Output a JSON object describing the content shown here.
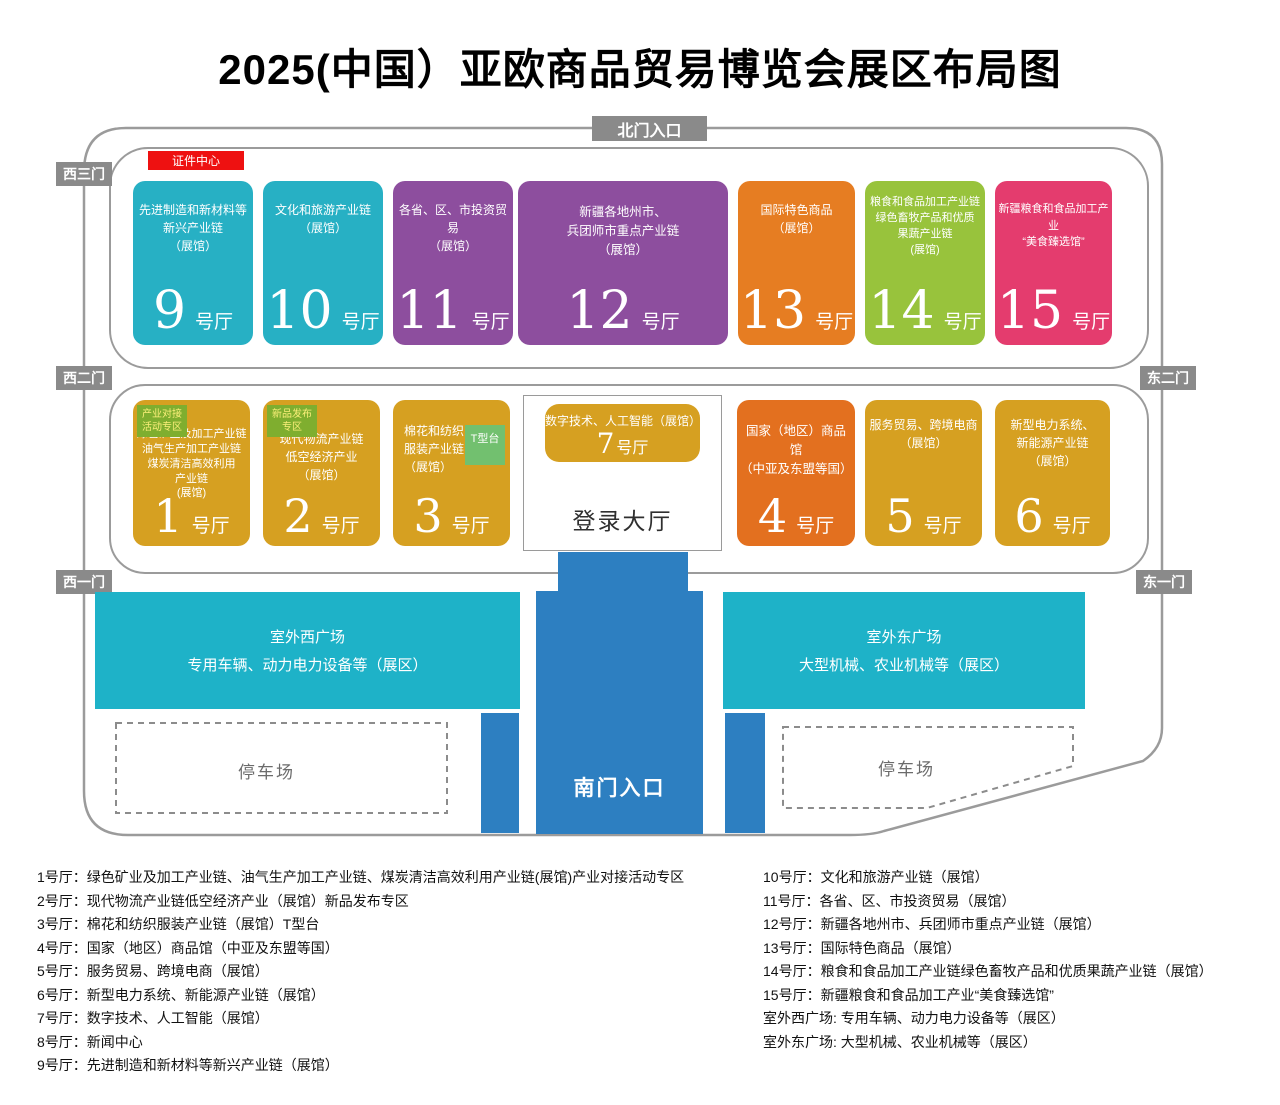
{
  "title": "2025(中国）亚欧商品贸易博览会展区布局图",
  "gates": {
    "north": "北门入口",
    "south": "南门入口",
    "west3": "西三门",
    "west2": "西二门",
    "west1": "西一门",
    "east2": "东二门",
    "east1": "东一门"
  },
  "credential_center": "证件中心",
  "login_hall": "登录大厅",
  "halls": {
    "h1": {
      "num": "1",
      "unit": "号厅",
      "desc": "绿色矿业及加工产业链\n油气生产加工产业链\n煤炭清洁高效利用\n产业链\n(展馆)",
      "badge": "产业对接\n活动专区",
      "color": "#d6a021"
    },
    "h2": {
      "num": "2",
      "unit": "号厅",
      "desc": "现代物流产业链\n低空经济产业\n（展馆）",
      "badge": "新品发布\n专区",
      "color": "#d6a021"
    },
    "h3": {
      "num": "3",
      "unit": "号厅",
      "desc": "棉花和纺织\n服装产业链\n（展馆）",
      "t_stage": "T型台",
      "color": "#d6a021"
    },
    "h4": {
      "num": "4",
      "unit": "号厅",
      "desc": "国家（地区）商品馆\n（中亚及东盟等国）",
      "color": "#e3701f"
    },
    "h5": {
      "num": "5",
      "unit": "号厅",
      "desc": "服务贸易、跨境电商\n（展馆）",
      "color": "#d6a021"
    },
    "h6": {
      "num": "6",
      "unit": "号厅",
      "desc": "新型电力系统、\n新能源产业链\n（展馆）",
      "color": "#d6a021"
    },
    "h7": {
      "num": "7",
      "unit": "号厅",
      "desc": "数字技术、人工智能（展馆）",
      "color": "#d6a021"
    },
    "h9": {
      "num": "9",
      "unit": "号厅",
      "desc": "先进制造和新材料等\n新兴产业链\n（展馆）",
      "color": "#27b0c4"
    },
    "h10": {
      "num": "10",
      "unit": "号厅",
      "desc": "文化和旅游产业链\n（展馆）",
      "color": "#27b0c4"
    },
    "h11": {
      "num": "11",
      "unit": "号厅",
      "desc": "各省、区、市投资贸易\n（展馆）",
      "color": "#8d4e9e"
    },
    "h12": {
      "num": "12",
      "unit": "号厅",
      "desc": "新疆各地州市、\n兵团师市重点产业链\n（展馆）",
      "color": "#8d4e9e"
    },
    "h13": {
      "num": "13",
      "unit": "号厅",
      "desc": "国际特色商品\n（展馆）",
      "color": "#e67d22"
    },
    "h14": {
      "num": "14",
      "unit": "号厅",
      "desc": "粮食和食品加工产业链\n绿色畜牧产品和优质\n果蔬产业链\n(展馆)",
      "color": "#98c33c"
    },
    "h15": {
      "num": "15",
      "unit": "号厅",
      "desc": "新疆粮食和食品加工产业\n“美食臻选馆”",
      "color": "#e43c6e"
    }
  },
  "plazas": {
    "west": {
      "name": "室外西广场",
      "desc": "专用车辆、动力电力设备等（展区）"
    },
    "east": {
      "name": "室外东广场",
      "desc": "大型机械、农业机械等（展区）"
    },
    "parking": "停车场"
  },
  "legend": {
    "left": [
      "1号厅：绿色矿业及加工产业链、油气生产加工产业链、煤炭清洁高效利用产业链(展馆)产业对接活动专区",
      "2号厅：现代物流产业链低空经济产业（展馆）新品发布专区",
      "3号厅：棉花和纺织服装产业链（展馆）T型台",
      "4号厅：国家（地区）商品馆（中亚及东盟等国）",
      "5号厅：服务贸易、跨境电商（展馆）",
      "6号厅：新型电力系统、新能源产业链（展馆）",
      "7号厅：数字技术、人工智能（展馆）",
      "8号厅：新闻中心",
      "9号厅：先进制造和新材料等新兴产业链（展馆）"
    ],
    "right": [
      "10号厅：文化和旅游产业链（展馆）",
      "11号厅：各省、区、市投资贸易（展馆）",
      "12号厅：新疆各地州市、兵团师市重点产业链（展馆）",
      "13号厅：国际特色商品（展馆）",
      "14号厅：粮食和食品加工产业链绿色畜牧产品和优质果蔬产业链（展馆）",
      "15号厅：新疆粮食和食品加工产业“美食臻选馆”",
      "室外西广场: 专用车辆、动力电力设备等（展区）",
      "室外东广场: 大型机械、农业机械等（展区）"
    ]
  },
  "colors": {
    "teal_hall": "#27b0c4",
    "purple_hall": "#8d4e9e",
    "orange_hall": "#e67d22",
    "deep_orange_hall": "#e3701f",
    "green_hall": "#98c33c",
    "pink_hall": "#e43c6e",
    "gold_hall": "#d6a021",
    "plaza_teal": "#1eb2c8",
    "corridor_blue": "#2d7fc1",
    "gate_gray": "#8a8a8a",
    "badge_green": "#7fae2f",
    "t_stage_green": "#72c06f",
    "credential_red": "#ee1111"
  }
}
